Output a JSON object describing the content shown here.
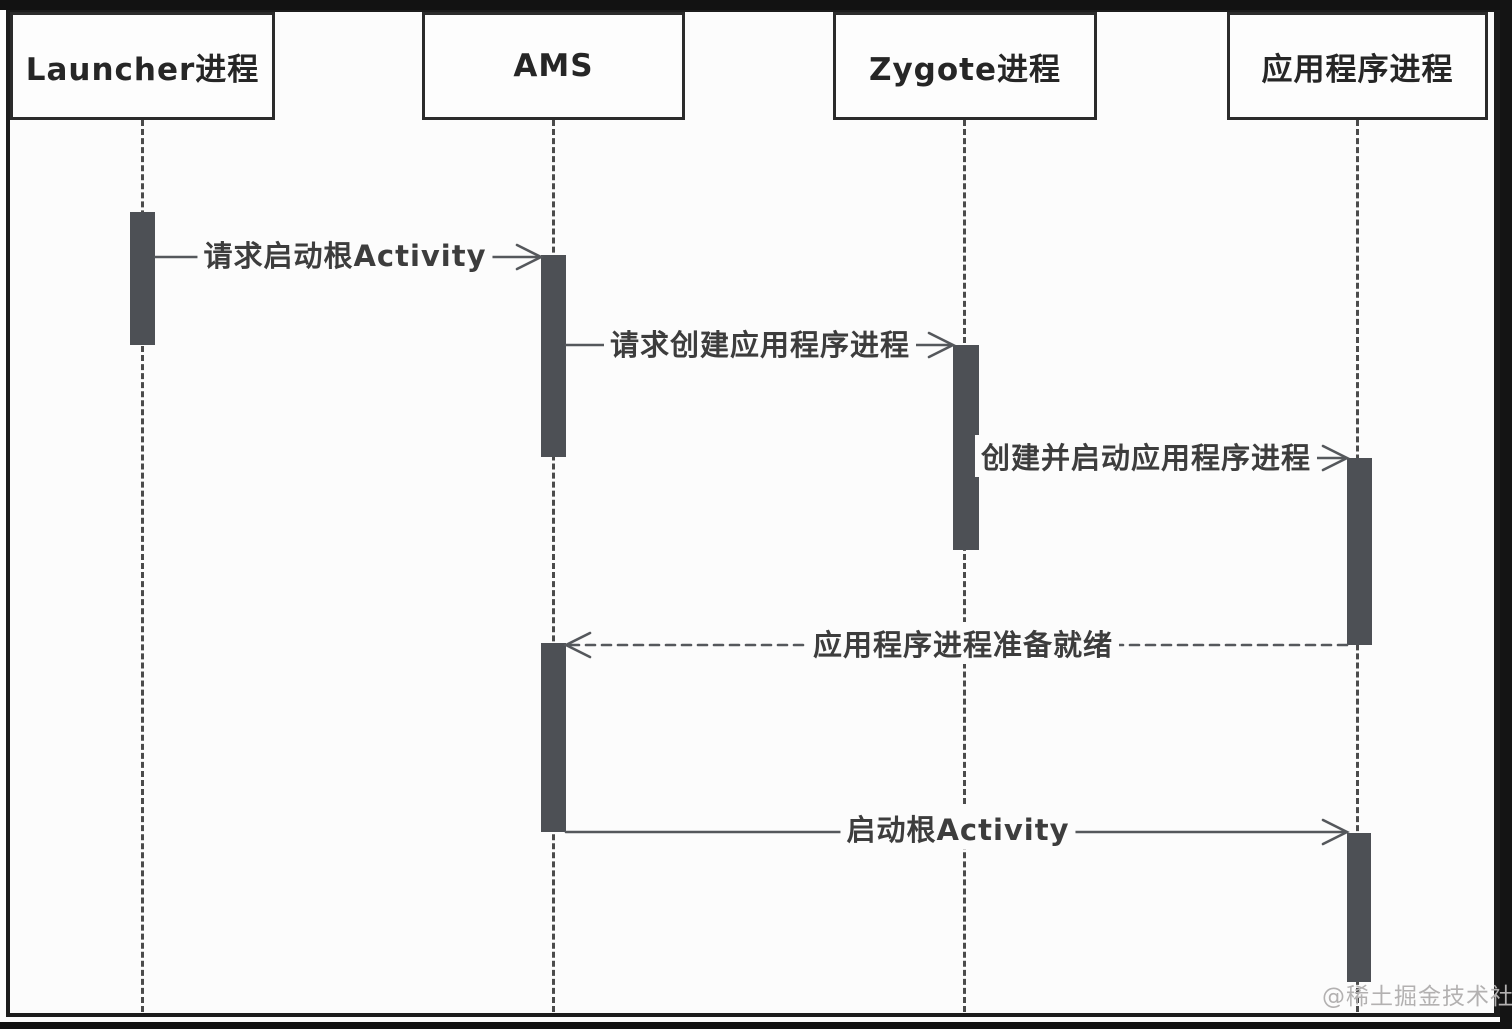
{
  "diagram": {
    "type": "uml-sequence",
    "subject": "Android root Activity launch flow",
    "background_color": "#fcfcfc",
    "frame_color": "#1c1c1c",
    "activation_bar_color": "#4d5055",
    "line_color": "#55585c",
    "text_color": "#3d3d3d"
  },
  "participants": [
    {
      "id": "launcher",
      "label": "Launcher进程"
    },
    {
      "id": "ams",
      "label": "AMS"
    },
    {
      "id": "zygote",
      "label": "Zygote进程"
    },
    {
      "id": "app",
      "label": "应用程序进程"
    }
  ],
  "messages": [
    {
      "from": "launcher",
      "to": "ams",
      "label": "请求启动根Activity",
      "line": "solid"
    },
    {
      "from": "ams",
      "to": "zygote",
      "label": "请求创建应用程序进程",
      "line": "solid"
    },
    {
      "from": "zygote",
      "to": "app",
      "label": "创建并启动应用程序进程",
      "line": "solid"
    },
    {
      "from": "app",
      "to": "ams",
      "label": "应用程序进程准备就绪",
      "line": "dashed"
    },
    {
      "from": "ams",
      "to": "app",
      "label": "启动根Activity",
      "line": "solid"
    }
  ],
  "watermark": {
    "text": "@稀土掘金技术社区"
  }
}
